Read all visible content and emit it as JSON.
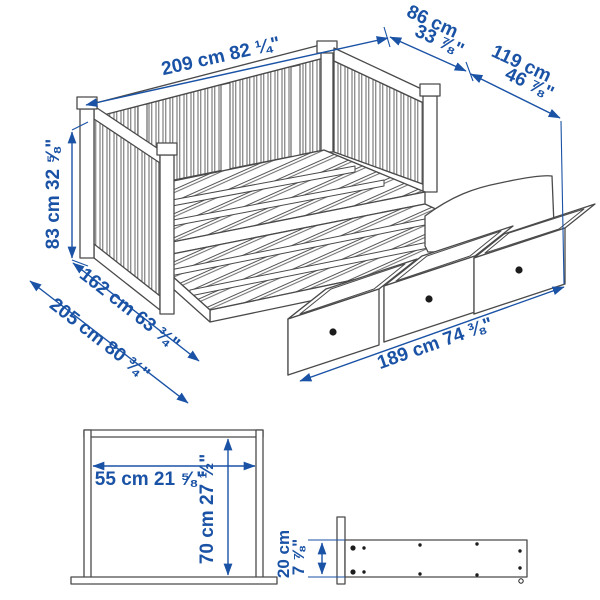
{
  "colors": {
    "dimension_blue": "#1a52a5",
    "line_gray": "#4a4a4a",
    "knob_black": "#1c1c1c"
  },
  "dimensions": {
    "length": "209 cm 82 ¼\"",
    "depth_line1": "86 cm",
    "depth_line2": "33 ⅞\"",
    "depth_extended_line1": "119 cm",
    "depth_extended_line2": "46 ⅞\"",
    "height": "83 cm 32 ⅝\"",
    "width_extended": "162 cm 63 ¾\"",
    "width_total": "205 cm 80 ¾\"",
    "drawer_span": "189 cm 74 ⅜\""
  },
  "under_bed_diagram": {
    "width": "55 cm 21 ⅝\"",
    "height": "70 cm 27 ½\""
  },
  "drawer_rail_diagram": {
    "height_line1": "20 cm",
    "height_line2": "7 ⅞\""
  }
}
